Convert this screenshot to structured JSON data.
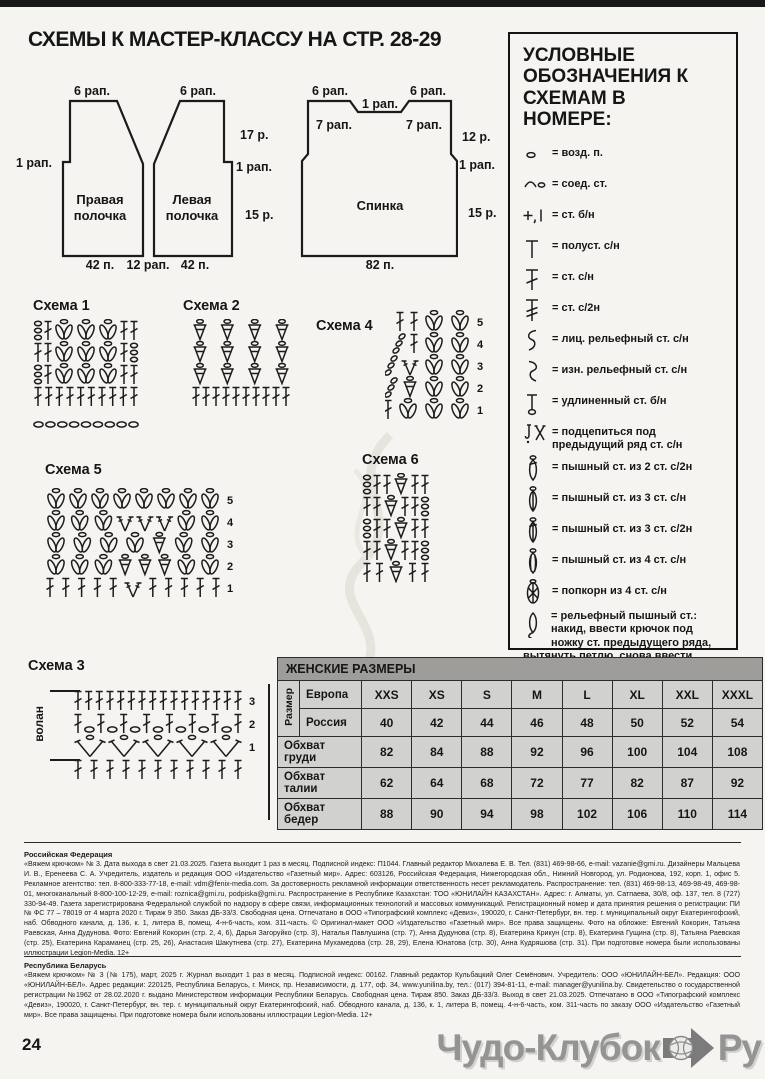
{
  "page": {
    "title": "СХЕМЫ К МАСТЕР-КЛАССУ НА СТР. 28-29",
    "page_number": "24",
    "watermark": {
      "text1": "Чудо-Клубок",
      "text2": "Ру"
    }
  },
  "patterns": {
    "right_front": {
      "name": "Правая полочка",
      "top": "6 рап.",
      "left_step": "1 рап.",
      "bottom": "42 п."
    },
    "between_bottom": "12 рап.",
    "left_front": {
      "name": "Левая полочка",
      "top": "6 рап.",
      "right_rows": "17 р.",
      "right_step": "1 рап.",
      "right_lower_rows": "15 р.",
      "bottom": "42 п."
    },
    "back": {
      "name": "Спинка",
      "top_left": "6 рап.",
      "top_center": "1 рап.",
      "top_right": "6 рап.",
      "shoulder_left": "7 рап.",
      "shoulder_right": "7 рап.",
      "right_rows": "12 р.",
      "right_step": "1 рап.",
      "right_lower_rows": "15 р.",
      "bottom": "82 п."
    }
  },
  "legend": {
    "title": "УСЛОВНЫЕ ОБОЗНАЧЕНИЯ К СХЕМАМ В НОМЕРЕ:",
    "items": [
      {
        "icon": "chain",
        "label": "= возд. п."
      },
      {
        "icon": "slst",
        "label": "= соед. ст."
      },
      {
        "icon": "sc",
        "label": "= ст. б/н"
      },
      {
        "icon": "hdc",
        "label": "= полуст. с/н"
      },
      {
        "icon": "dc",
        "label": "= ст. с/н"
      },
      {
        "icon": "dc2",
        "label": "= ст. с/2н"
      },
      {
        "icon": "fpdc",
        "label": "= лиц. рельефный ст. с/н"
      },
      {
        "icon": "bpdc",
        "label": "= изн. рельефный ст. с/н"
      },
      {
        "icon": "esc",
        "label": "= удлиненный ст. б/н"
      },
      {
        "icon": "under",
        "label": "= подцепиться под предыдущий ряд ст. с/н"
      },
      {
        "icon": "puff2",
        "label": "= пышный ст. из 2 ст. с/2н"
      },
      {
        "icon": "puff3",
        "label": "= пышный ст. из 3 ст. с/н"
      },
      {
        "icon": "puff3t",
        "label": "= пышный ст. из 3 ст. с/2н"
      },
      {
        "icon": "puff4",
        "label": "= пышный ст. из 4 ст. с/н"
      },
      {
        "icon": "popcorn",
        "label": "= попкорн из 4 ст. с/н"
      },
      {
        "icon": "reliefpuff",
        "label": "= рельефный пышный ст.: накид, ввести крючок под ножку ст. предыдущего ряда, вытянуть петлю, снова ввести крючок под ножку ст. с/н предыдущего ряда, вытянуть петлю, на крючке 5 п.; сначала провязать вместе 4 п., затем 2 п.",
        "long": true
      },
      {
        "icon": "picot",
        "label": "= 3 пико из 4 возд. п."
      }
    ]
  },
  "schemes": [
    {
      "title": "Схема 1",
      "rows": [
        [
          "chcol",
          "dc",
          "shell",
          "shell",
          "shell",
          "dc",
          "dc"
        ],
        [
          "dc",
          "dc",
          "shell",
          "shell",
          "shell",
          "dc",
          "chcol"
        ],
        [
          "chcol",
          "dc",
          "shell",
          "shell",
          "shell",
          "dc",
          "dc"
        ],
        [
          "dc",
          "dc",
          "dc",
          "dc",
          "dc",
          "dc",
          "dc",
          "dc",
          "dc",
          "dc"
        ],
        [
          "ch",
          "ch",
          "ch",
          "ch",
          "ch",
          "ch",
          "ch",
          "ch",
          "ch"
        ]
      ]
    },
    {
      "title": "Схема 2",
      "rows": [
        [
          "cone",
          "cone",
          "cone",
          "cone"
        ],
        [
          "cone",
          "cone",
          "cone",
          "cone"
        ],
        [
          "cone",
          "cone",
          "cone",
          "cone"
        ],
        [
          "dc",
          "dc",
          "dc",
          "dc",
          "dc",
          "dc",
          "dc",
          "dc",
          "dc",
          "dc"
        ]
      ]
    },
    {
      "title": "Схема 4",
      "justify": false,
      "align": "right",
      "gap": 4,
      "row_numbers": [
        "5",
        "4",
        "3",
        "2",
        "1"
      ],
      "rows": [
        [
          "dc",
          "dc",
          "shell",
          "shell"
        ],
        [
          "chslant",
          "dc",
          "shell",
          "shell"
        ],
        [
          "chslant",
          "vst",
          "shell",
          "shell"
        ],
        [
          "chslant",
          "cone",
          "shell",
          "shell"
        ],
        [
          "dc",
          "dc",
          "shell",
          "shell",
          "shell"
        ]
      ]
    },
    {
      "title": "Схема 5",
      "row_numbers": [
        "5",
        "4",
        "3",
        "2",
        "1"
      ],
      "rows": [
        [
          "shell",
          "shell",
          "shell",
          "shell",
          "shell",
          "shell",
          "shell",
          "shell"
        ],
        [
          "shell",
          "shell",
          "shell",
          "vst",
          "vst",
          "vst",
          "shell",
          "shell"
        ],
        [
          "shell",
          "shell",
          "shell",
          "shell",
          "cone",
          "shell",
          "shell"
        ],
        [
          "shell",
          "shell",
          "shell",
          "cone",
          "cone",
          "cone",
          "shell",
          "shell"
        ],
        [
          "dc",
          "dc",
          "dc",
          "dc",
          "dc",
          "vst",
          "dc",
          "dc",
          "dc",
          "dc",
          "dc"
        ]
      ]
    },
    {
      "title": "Схема 6",
      "rows": [
        [
          "chcol",
          "dc",
          "dc",
          "cone",
          "dc",
          "dc"
        ],
        [
          "dc",
          "dc",
          "cone",
          "dc",
          "dc",
          "chcol"
        ],
        [
          "chcol",
          "dc",
          "dc",
          "cone",
          "dc",
          "dc"
        ],
        [
          "dc",
          "dc",
          "cone",
          "dc",
          "dc",
          "chcol"
        ],
        [
          "dc",
          "dc",
          "cone",
          "dc",
          "dc"
        ]
      ]
    },
    {
      "title": "Схема 3",
      "rowH": 23,
      "side_label": "волан",
      "row_numbers": [
        "3",
        "2",
        "1",
        ""
      ],
      "rows": [
        [
          "dc",
          "dc",
          "dc",
          "dc",
          "dc",
          "dc",
          "dc",
          "dc",
          "dc",
          "dc",
          "dc",
          "dc",
          "dc",
          "dc",
          "dc",
          "dc"
        ],
        [
          "dc",
          "ch",
          "dc",
          "ch",
          "dc",
          "ch",
          "dc",
          "ch",
          "dc",
          "ch",
          "dc",
          "ch",
          "dc",
          "ch",
          "dc"
        ],
        [
          "vbig",
          "vbig",
          "vbig",
          "vbig",
          "vbig"
        ],
        [
          "dc",
          "dc",
          "dc",
          "dc",
          "dc",
          "dc",
          "dc",
          "dc",
          "dc",
          "dc",
          "dc"
        ]
      ]
    }
  ],
  "size_table": {
    "title": "ЖЕНСКИЕ РАЗМЕРЫ",
    "row_header": "Размер",
    "europe_label": "Европа",
    "russia_label": "Россия",
    "europe": [
      "XXS",
      "XS",
      "S",
      "M",
      "L",
      "XL",
      "XXL",
      "XXXL"
    ],
    "russia": [
      "40",
      "42",
      "44",
      "46",
      "48",
      "50",
      "52",
      "54"
    ],
    "rows": [
      {
        "label": "Обхват груди",
        "values": [
          "82",
          "84",
          "88",
          "92",
          "96",
          "100",
          "104",
          "108"
        ]
      },
      {
        "label": "Обхват талии",
        "values": [
          "62",
          "64",
          "68",
          "72",
          "77",
          "82",
          "87",
          "92"
        ]
      },
      {
        "label": "Обхват бедер",
        "values": [
          "88",
          "90",
          "94",
          "98",
          "102",
          "106",
          "110",
          "114"
        ]
      }
    ]
  },
  "footer": {
    "russia_title": "Российская Федерация",
    "russia_text": "«Вяжем крючком» № 3. Дата выхода в свет 21.03.2025. Газета выходит 1 раз в месяц. Подписной индекс: П1044. Главный редактор Михалева Е. В. Тел. (831) 469-98-66, e-mail: vazanie@gmi.ru. Дизайнеры Мальцева И. В., Еренеева С. А. Учредитель, издатель и редакция ООО «Издательство «Газетный мир». Адрес: 603126, Российская Федерация, Нижегородская обл., Нижний Новгород, ул. Родионова, 192, корп. 1, офис 5. Рекламное агентство: тел. 8-800-333-77-18, e-mail: vdm@fenix-media.com. За достоверность рекламной информации ответственность несет рекламодатель. Распространение: тел. (831) 469-98-13, 469-98-49, 469-98-01, многоканальный 8-800-100-12-29, e-mail: roznica@gmi.ru, podpiska@gmi.ru. Распространение в Республике Казахстан: ТОО «ЮНИЛАЙН КАЗАХСТАН». Адрес: г. Алматы, ул. Сатпаева, 30/8, оф. 137, тел. 8 (727) 330-94-49. Газета зарегистрирована Федеральной службой по надзору в сфере связи, информационных технологий и массовых коммуникаций. Регистрационный номер и дата принятия решения о регистрации: ПИ № ФС 77 – 78019 от 4 марта 2020 г. Тираж 9 350. Заказ ДБ-33/3. Свободная цена. Отпечатано в ООО «Типографский комплекс «Девиз», 190020, г. Санкт-Петербург, вн. тер. г. муниципальный округ Екатерингофский, наб. Обводного канала, д. 136, к. 1, литера В, помещ. 4-н-6-часть, ком. 311-часть. © Оригинал-макет ООО «Издательство «Газетный мир». Все права защищены. Фото на обложке: Евгений Кокорин, Татьяна Раевская, Анна Дудунова. Фото: Евгений Кокорин (стр. 2, 4, 6), Дарья Загоруйко (стр. 3), Наталья Павлушина (стр. 7), Анна Дудунова (стр. 8), Екатерина Крикун (стр. 8), Екатерина Гущина (стр. 8), Татьяна Раевская (стр. 25), Екатерина Караманец (стр. 25, 26), Анастасия Шакутнева (стр. 27), Екатерина Мухамедова (стр. 28, 29), Елена Юнатова (стр. 30), Анна Кудряшова (стр. 31). При подготовке номера были использованы иллюстрации Legion-Media. 12+",
    "belarus_title": "Республика Беларусь",
    "belarus_text": "«Вяжем крючком» № 3 (№ 175), март, 2025 г. Журнал выходит 1 раз в месяц. Подписной индекс: 00162. Главный редактор Кульбацкий Олег Семёнович. Учредитель: ООО «ЮНИЛАЙН-БЕЛ». Редакция: ООО «ЮНИЛАЙН-БЕЛ». Адрес редакции: 220125, Республика Беларусь, г. Минск, пр. Независимости, д. 177, оф. 34, www.yunilina.by, тел.: (017) 394-81-11, e-mail: manager@yunilina.by. Свидетельство о государственной регистрации №1962 от 28.02.2020 г. выдано Министерством информации Республики Беларусь. Свободная цена. Тираж 850. Заказ ДБ-33/3. Выход в свет 21.03.2025. Отпечатано в ООО «Типографский комплекс «Девиз», 190020, г. Санкт-Петербург, вн. тер. г. муниципальный округ Екатерингофский, наб. Обводного канала, д. 136, к. 1, литера В, помещ. 4-н-6-часть, ком. 311-часть по заказу ООО «Издательство «Газетный мир». Все права защищены. При подготовке номера были использованы иллюстрации Legion-Media. 12+"
  }
}
